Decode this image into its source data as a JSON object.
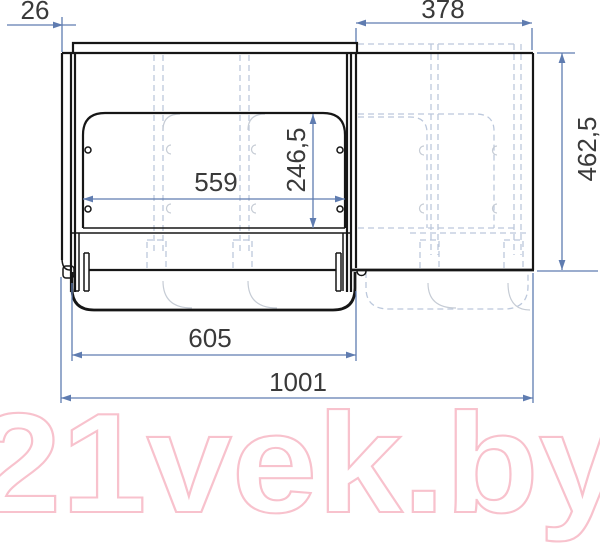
{
  "title": "Furniture drawer dimensional drawing",
  "dimensions": {
    "side_thickness": {
      "label": "26"
    },
    "top_right_width": {
      "label": "378"
    },
    "panel_width": {
      "label": "559"
    },
    "panel_height": {
      "label": "246,5"
    },
    "overall_height": {
      "label": "462,5"
    },
    "drawer_width": {
      "label": "605"
    },
    "overall_width": {
      "label": "1001"
    }
  },
  "watermark": {
    "text": "21vek.by"
  },
  "colors": {
    "structure": "#161616",
    "ghost": "#bcc8dc",
    "hidden": "#c6ccd5",
    "dimension": "#5f7cb0",
    "text": "#3a3a3a",
    "watermark": "#f8c2cd"
  }
}
